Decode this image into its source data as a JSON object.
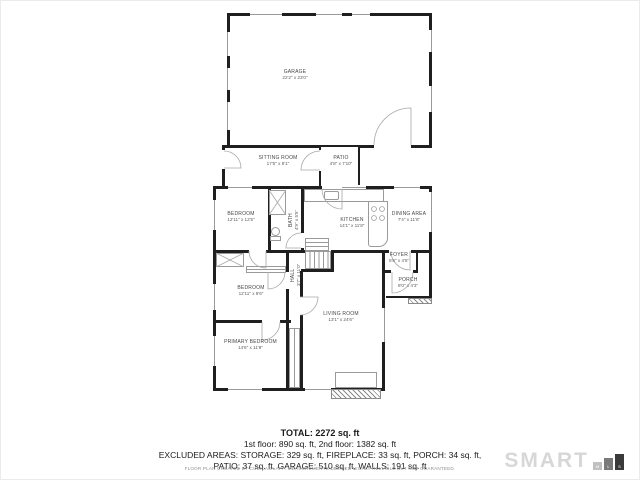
{
  "rooms": {
    "garage": {
      "name": "GARAGE",
      "dims": "22'2\" x 23'0\""
    },
    "sitting_room": {
      "name": "SITTING ROOM",
      "dims": "17'5\" x 8'1\""
    },
    "patio": {
      "name": "PATIO",
      "dims": "4'8\" x 7'10\""
    },
    "bedroom1": {
      "name": "BEDROOM",
      "dims": "12'11\" x 12'5\""
    },
    "bath": {
      "name": "BATH",
      "dims": "4'9\" x 5'5\""
    },
    "kitchen": {
      "name": "KITCHEN",
      "dims": "14'1\" x 11'8\""
    },
    "dining_area": {
      "name": "DINING AREA",
      "dims": "7'4\" x 11'6\""
    },
    "hall": {
      "name": "HALL",
      "dims": "3'7\" x 11'0\""
    },
    "foyer": {
      "name": "FOYER",
      "dims": "5'8\" x 4'5\""
    },
    "porch": {
      "name": "PORCH",
      "dims": "8'0\" x 4'3\""
    },
    "bedroom2": {
      "name": "BEDROOM",
      "dims": "12'11\" x 9'6\""
    },
    "primary_bedroom": {
      "name": "PRIMARY BEDROOM",
      "dims": "14'6\" x 11'8\""
    },
    "living_room": {
      "name": "LIVING ROOM",
      "dims": "13'1\" x 24'6\""
    }
  },
  "summary": {
    "total": "TOTAL: 2272 sq. ft",
    "lines": [
      "1st floor: 890 sq. ft, 2nd floor: 1382 sq. ft",
      "EXCLUDED AREAS: STORAGE: 329 sq. ft, FIREPLACE: 33 sq. ft, PORCH: 34 sq. ft,",
      "PATIO: 37 sq. ft, GARAGE: 510 sq. ft, WALLS: 191 sq. ft"
    ]
  },
  "footer": {
    "disclaimer": "FLOOR PLAN CREATED BY CUBICASA APP. MEASUREMENTS DEEMED HIGHLY RELIABLE BUT NOT GUARANTEED.",
    "logo": {
      "text": "SMART",
      "bar_letters": [
        "M",
        "L",
        "S"
      ]
    }
  },
  "colors": {
    "wall": "#1f1f1f",
    "fixture_line": "#9a9a9a",
    "logo_word": "#d7d7d7",
    "logo_bar_m": "#c0c0c0",
    "logo_bar_l": "#7a7a7a",
    "logo_bar_s": "#3a3a3a",
    "background": "#ffffff"
  }
}
